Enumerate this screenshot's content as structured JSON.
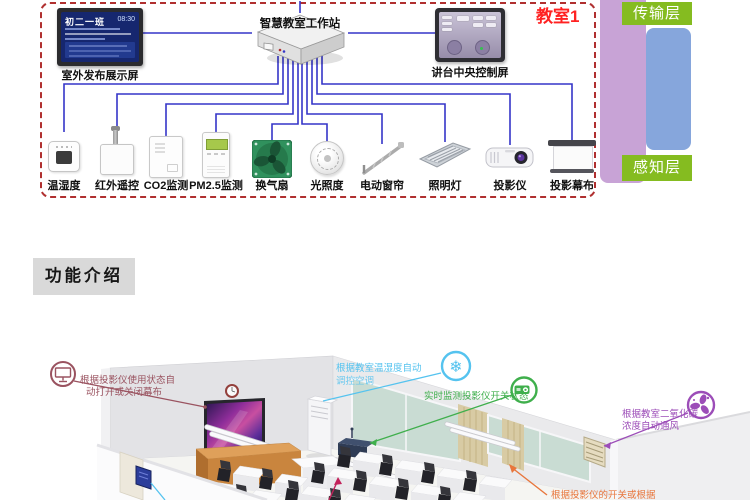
{
  "architecture": {
    "classroom_tag": "教室1",
    "layers": {
      "transmission": "传输层",
      "perception": "感知层"
    },
    "outdoor_screen": {
      "class_name": "初二一班",
      "time": "08:30",
      "label": "室外发布展示屏"
    },
    "workstation_label": "智慧教室工作站",
    "podium_screen_label": "讲台中央控制屏",
    "devices": [
      {
        "name": "温湿度",
        "icon": "temperature-humidity-sensor-icon"
      },
      {
        "name": "红外遥控",
        "icon": "infrared-remote-icon"
      },
      {
        "name": "CO2监测",
        "icon": "co2-monitor-icon"
      },
      {
        "name": "PM2.5监测",
        "icon": "pm25-monitor-icon"
      },
      {
        "name": "换气扇",
        "icon": "ventilation-fan-icon"
      },
      {
        "name": "光照度",
        "icon": "light-sensor-icon"
      },
      {
        "name": "电动窗帘",
        "icon": "electric-curtain-icon"
      },
      {
        "name": "照明灯",
        "icon": "ceiling-light-icon"
      },
      {
        "name": "投影仪",
        "icon": "projector-icon"
      },
      {
        "name": "投影幕布",
        "icon": "projection-screen-icon"
      }
    ],
    "colors": {
      "connection_line_blue": "#3535C8",
      "boundary_dashed_red": "#B03030",
      "classroom_tag_red": "#FF2222",
      "layer_badge_green": "#85BC20",
      "transmission_bar_purple": "#C8A3D6",
      "perception_bar_blue": "#86A6DC"
    }
  },
  "section_header": "功能介绍",
  "function_annotations": [
    {
      "id": "curtain-auto",
      "icon": "projection-screen-icon",
      "color": "#9A5360",
      "line1": "根据投影仪使用状态自",
      "line2": "动打开或关闭幕布"
    },
    {
      "id": "ac-auto",
      "icon": "snowflake-icon",
      "color": "#55C3EF",
      "line1": "根据教室温湿度自动",
      "line2": "调控空调"
    },
    {
      "id": "projector-monitor",
      "icon": "projector-icon",
      "color": "#3FAF4C",
      "line1": "实时监测投影仪开关状态",
      "line2": ""
    },
    {
      "id": "co2-vent",
      "icon": "fan-molecule-icon",
      "color": "#9C4DB8",
      "line1": "根据教室二氧化碳",
      "line2": "浓度自动通风"
    },
    {
      "id": "projector-switch",
      "icon": "",
      "color": "#E8763C",
      "line1": "根据投影仪的开关或根据",
      "line2": ""
    }
  ],
  "misc": {
    "snowflake_glyph": "❄"
  }
}
